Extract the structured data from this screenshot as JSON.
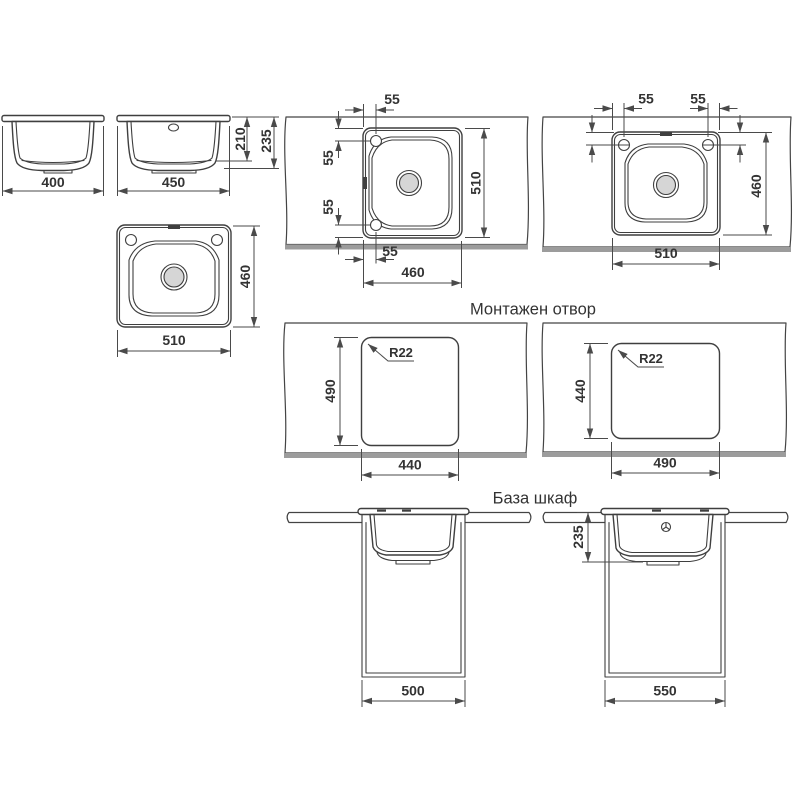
{
  "titles": {
    "mounting_hole": "Монтажен отвор",
    "base_cabinet": "База шкаф"
  },
  "side_view_small": {
    "width": "400"
  },
  "side_view_large": {
    "width": "450",
    "bowl_depth": "210",
    "overall_depth": "235"
  },
  "top_view": {
    "width": "510",
    "depth": "460"
  },
  "built_in_portrait": {
    "tap_offset_top": "55",
    "tap_offset_side_top": "55",
    "tap_offset_side_bottom": "55",
    "tap_offset_bottom": "55",
    "width": "460",
    "depth": "510"
  },
  "built_in_landscape": {
    "tap_offset_left": "55",
    "tap_offset_right": "55",
    "tap_offset_side_left": "55",
    "tap_offset_side_right": "55",
    "width": "510",
    "depth": "460"
  },
  "cutout_small": {
    "corner_radius": "R22",
    "width": "440",
    "depth": "490"
  },
  "cutout_large": {
    "corner_radius": "R22",
    "width": "490",
    "depth": "440"
  },
  "base_cabinet_small": {
    "width": "500"
  },
  "base_cabinet_large": {
    "bowl_depth": "235",
    "width": "550"
  },
  "colors": {
    "line": "#3f3f3f",
    "dimension": "#4a4a4a",
    "countertop_shadow": "#9c9c9c",
    "drain_fill": "#d6d6d6",
    "background": "#ffffff"
  }
}
